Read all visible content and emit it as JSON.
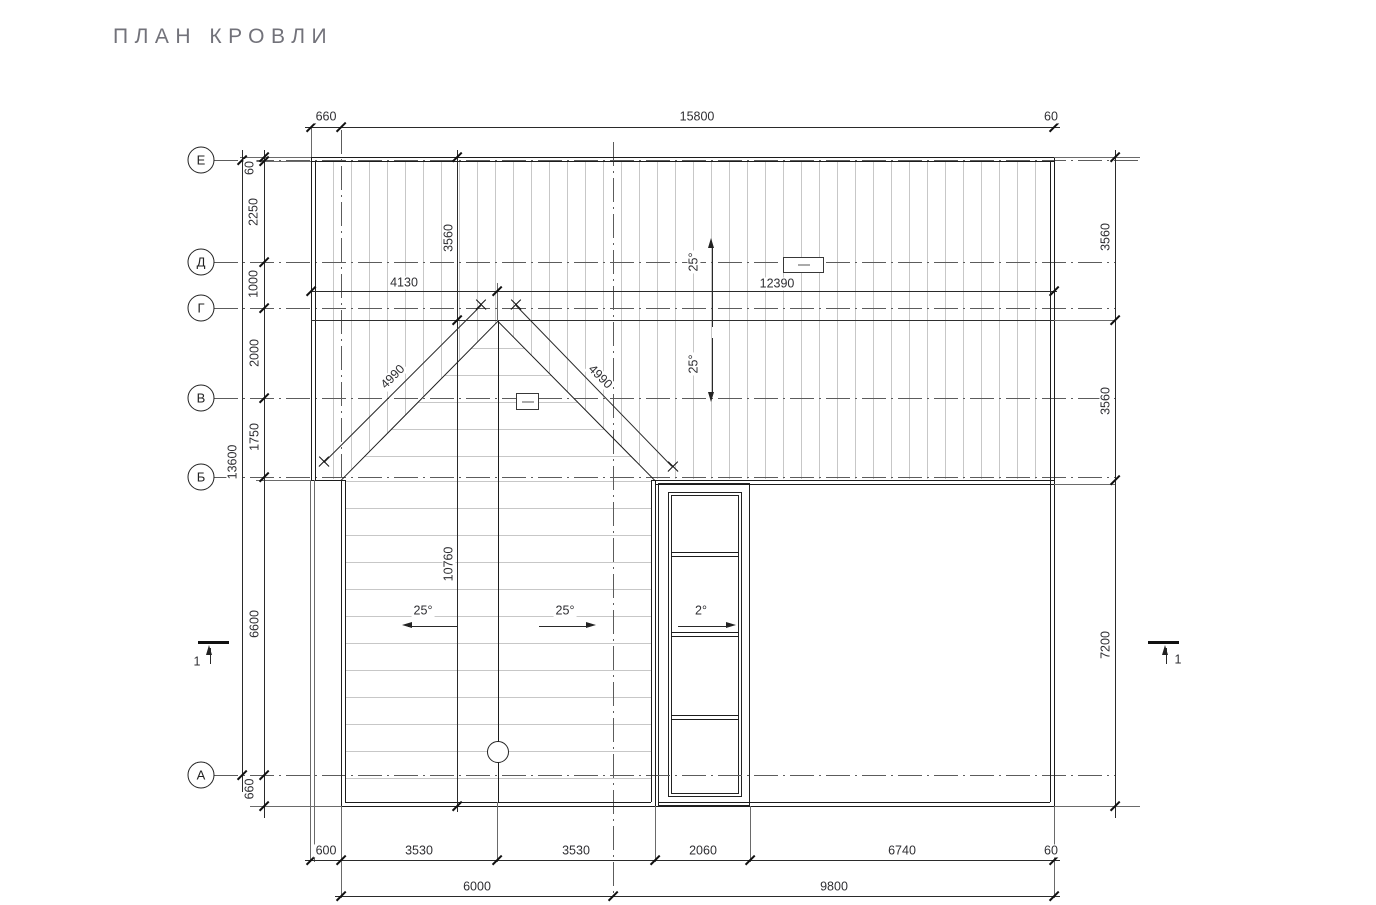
{
  "title": "ПЛАН КРОВЛИ",
  "axes": {
    "E": "Е",
    "D": "Д",
    "G": "Г",
    "V": "В",
    "B": "Б",
    "A": "А"
  },
  "dims": {
    "top_660": "660",
    "top_15800": "15800",
    "top_60": "60",
    "mid_4130": "4130",
    "mid_12390": "12390",
    "valley_left": "4990",
    "valley_right": "4990",
    "left_13600": "13600",
    "left_60": "60",
    "left_2250": "2250",
    "left_1000": "1000",
    "left_2000": "2000",
    "left_1750": "1750",
    "left_6600": "6600",
    "left_660": "660",
    "right_3560_top": "3560",
    "right_3560_mid": "3560",
    "right_7200": "7200",
    "int_3560": "3560",
    "int_10760": "10760",
    "b1_600": "600",
    "b1_3530a": "3530",
    "b1_3530b": "3530",
    "b1_2060": "2060",
    "b1_6740": "6740",
    "b1_60": "60",
    "b2_6000": "6000",
    "b2_9800": "9800"
  },
  "slopes": {
    "upper": "25°",
    "lower": "25°",
    "gable_left": "25°",
    "gable_right": "25°",
    "shaft": "2°"
  },
  "sections": {
    "left": "1",
    "right": "1"
  },
  "colors": {
    "line": "#1c1c1c",
    "axis": "#5c5c5c",
    "hatch": "#c7c7c7",
    "text": "#2f2f33",
    "title": "#72727a"
  }
}
